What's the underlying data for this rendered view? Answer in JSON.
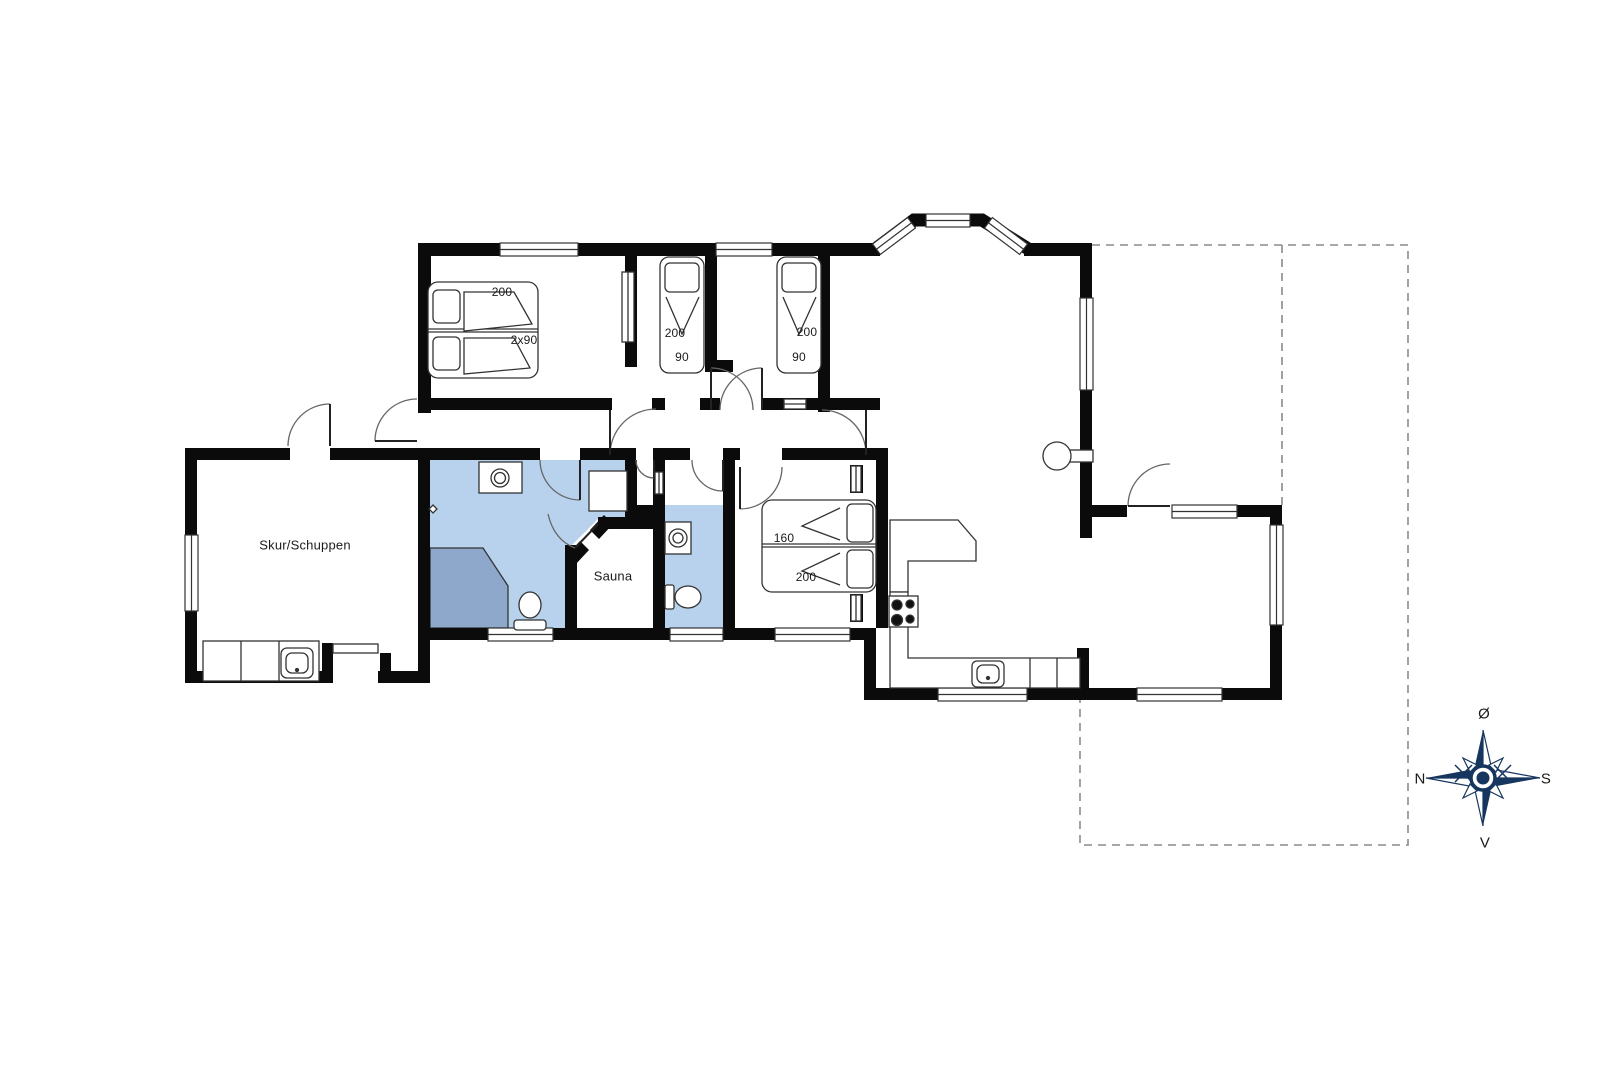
{
  "colors": {
    "wall": "#0b0b0b",
    "bath_floor": "#b8d2ee",
    "shower_floor": "#8ea8cc",
    "compass_navy": "#16365f",
    "thin_line": "#333333",
    "terrace_dash": "#8a8a8a"
  },
  "rooms": {
    "shed_label": "Skur/Schuppen",
    "sauna_label": "Sauna"
  },
  "beds": {
    "bedroom1": {
      "length": "200",
      "width": "2x90"
    },
    "bedroom2": {
      "length": "200",
      "width": "90"
    },
    "bedroom3": {
      "length": "200",
      "width": "90"
    },
    "bedroom4": {
      "width": "160",
      "length": "200"
    }
  },
  "compass": {
    "east": "Ø",
    "south": "S",
    "west": "V",
    "north": "N"
  }
}
